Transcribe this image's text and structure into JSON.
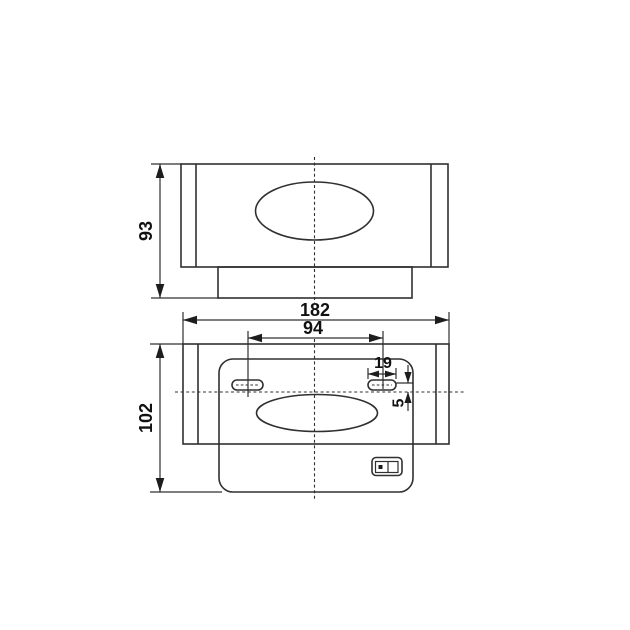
{
  "canvas": {
    "background": "#ffffff",
    "line_color": "#303030",
    "text_color": "#111111"
  },
  "drawing": {
    "views": {
      "front": {
        "name": "front-view"
      },
      "bottom": {
        "name": "bottom-view"
      }
    },
    "components": {
      "front_oval": "oval-opening",
      "bottom_oval": "oval-opening",
      "left_slot": "mounting-slot",
      "right_slot": "mounting-slot",
      "switch": "power-switch"
    },
    "dimensions": {
      "front_height": {
        "label": "93"
      },
      "overall_width": {
        "label": "182"
      },
      "slot_spacing": {
        "label": "94"
      },
      "slot_width": {
        "label": "19"
      },
      "slot_offset": {
        "label": "5"
      },
      "back_height": {
        "label": "102"
      }
    }
  }
}
